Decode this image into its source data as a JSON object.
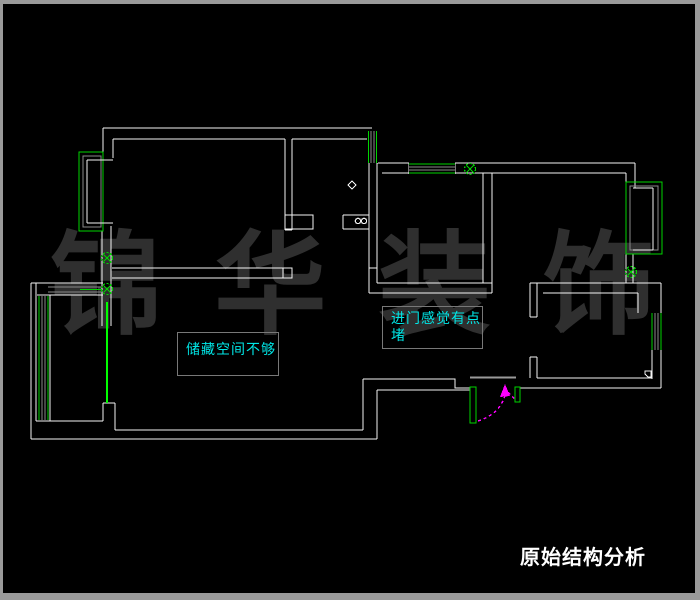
{
  "window": {
    "background": "#000000",
    "frame_color": "#9a9a9a"
  },
  "drawing": {
    "wall_color": "#f4f4f4",
    "window_color": "#00d400",
    "door_leaf_color": "#00ff00",
    "glass_line_color": "#8a8a8a",
    "door_swing_color": "#ff00ff",
    "symbols": [
      "hinge-marker-circle-x-left-upper",
      "hinge-marker-circle-x-left-lower",
      "hinge-marker-circle-x-kitchen-window",
      "hinge-marker-circle-x-right-wall",
      "bathroom-diamond-marker",
      "bathroom-double-circle-marker",
      "entry-level-marker"
    ]
  },
  "annotations": {
    "storage": {
      "text": "储藏空间不够",
      "color": "#00e6e6"
    },
    "entry": {
      "line1": "进门感觉有点",
      "line2": "堵",
      "color": "#00e6e6"
    }
  },
  "watermark": {
    "chars": [
      "锦",
      "华",
      "装",
      "饰"
    ],
    "color": "#2f2f2f"
  },
  "title": {
    "text": "原始结构分析",
    "color": "#ffffff"
  }
}
